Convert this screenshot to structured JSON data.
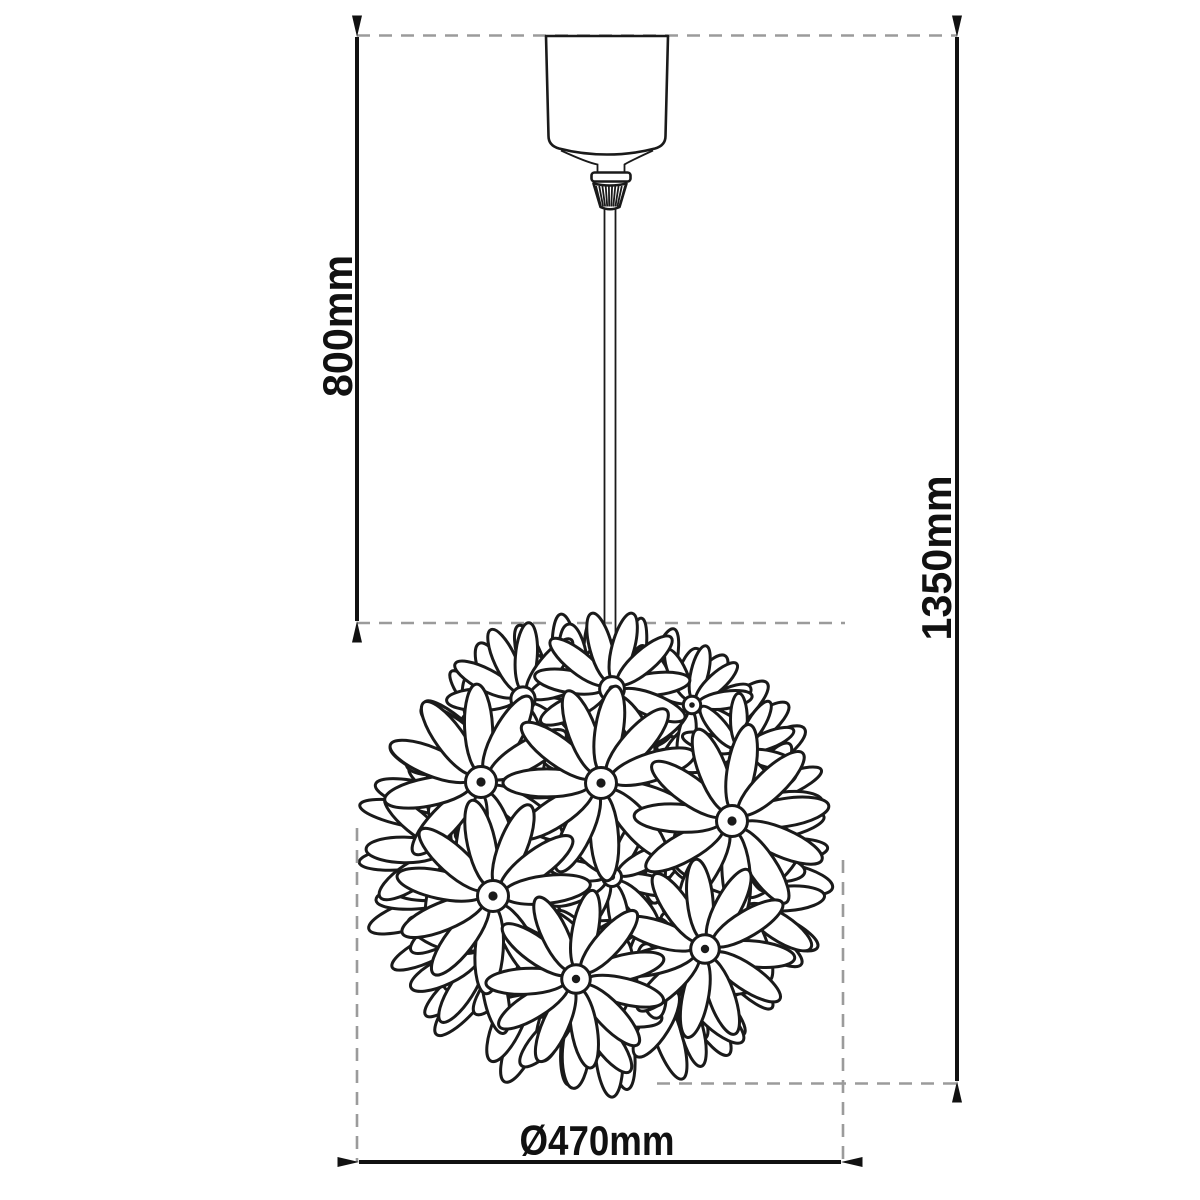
{
  "diagram": {
    "type": "technical-dimension-drawing",
    "subject": "flower-ball pendant lamp",
    "dimensions": {
      "cable_drop": "800mm",
      "total_height": "1350mm",
      "shade_diameter": "Ø470mm"
    },
    "colors": {
      "line": "#1a1a1a",
      "dimension_line": "#111111",
      "dashed_guide": "#9b9b9b",
      "background": "#ffffff"
    }
  }
}
